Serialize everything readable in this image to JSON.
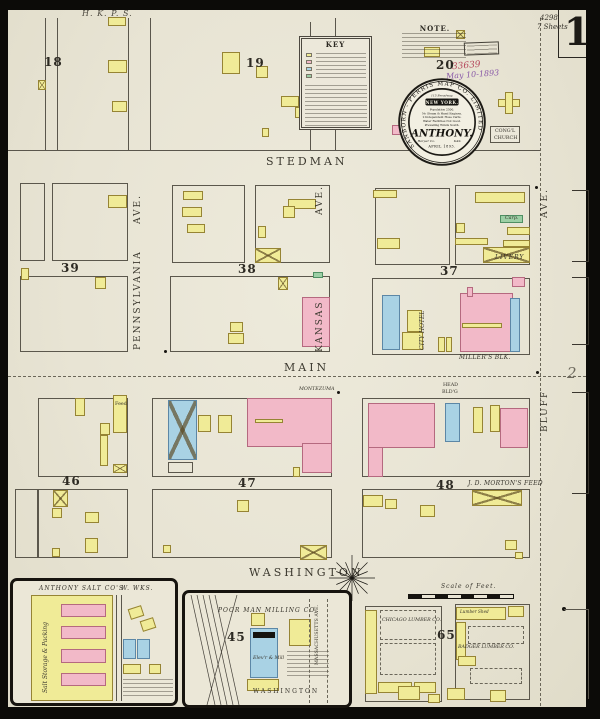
{
  "sheet": {
    "number": "1",
    "index_top": "4298",
    "index_bottom": "7 Sheets",
    "adjacent_ref": "2",
    "pencil_note": "H. K. P. S.",
    "received_number": "33639",
    "received_date": "May 10-1893"
  },
  "panels": {
    "note_title": "NOTE.",
    "key_title": "KEY"
  },
  "seal": {
    "arc_text": "SANBORN - PERRIS MAP CO. LIMITED",
    "address": "115 Broadway.",
    "city": "NEW YORK.",
    "facts": [
      "Population 2500.",
      "No Steam & Hand Engines.",
      "2 Independent Hose Carts.",
      "Water Facilities Not Good.",
      "Prevailing Winds South."
    ],
    "town": "ANTHONY.",
    "county": "Harper Co.",
    "state": "KAS.",
    "date": "APRIL 1893."
  },
  "streets": {
    "stedman": "STEDMAN",
    "main": "MAIN",
    "washington": "WASHINGTON",
    "washington_inset": "WASHINGTON",
    "pennsylvania": "PENNSYLVANIA",
    "pennsylvania_ave": "AVE.",
    "kansas": "KANSAS",
    "kansas_ave": "AVE.",
    "bluff": "BLUFF",
    "bluff_ave": "AVE.",
    "massachusetts": "MASSACHUSETTS AVE."
  },
  "blocks": {
    "b18": "18",
    "b19": "19",
    "b20": "20",
    "b39": "39",
    "b38": "38",
    "b37": "37",
    "b46": "46",
    "b47": "47",
    "b48": "48",
    "b45": "45",
    "b65": "65"
  },
  "labels": {
    "congl_church_1": "CONG'L",
    "congl_church_2": "CHURCH",
    "livery": "LIVERY",
    "carpenter": "Carp.",
    "millers_blk": "MILLER'S BLK.",
    "city_hotel": "CITY HOTEL",
    "montezuma": "MONTEZUMA",
    "head_bldg_1": "HEAD",
    "head_bldg_2": "BLD'G",
    "mortons_feed": "J. D. MORTON'S FEED",
    "feed": "Feed",
    "salt_title": "ANTHONY SALT CO'S",
    "water_works": "W. WKS.",
    "salt_storage": "Salt Storage & Packing",
    "poor_man": "POOR MAN MILLING CO.",
    "elevator_mill": "Elev'r & Mill",
    "chicago": "CHICAGO LUMBER CO.",
    "badger": "BADGER LUMBER CO.",
    "lumber_shed": "Lumber Shed",
    "scale_of_feet": "Scale of Feet."
  },
  "colors": {
    "paper": "#eae6d7",
    "frame_yellow": "#f0eb97",
    "brick_pink": "#f2b9c8",
    "stone_blue": "#a9d2e4",
    "special_green": "#9ccfa5",
    "ink": "#3e3b33",
    "received_ink": "#b5485c"
  }
}
